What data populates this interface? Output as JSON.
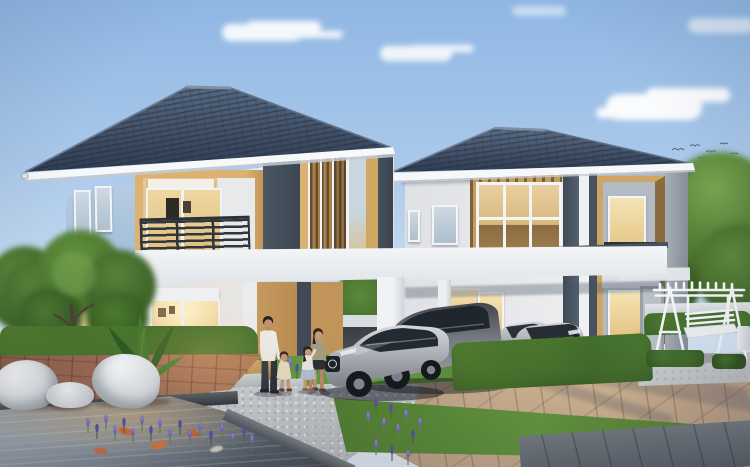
{
  "labels": {
    "scene": "3D rendering of two modern two-storey houses at dusk with garden, carport and koi pond",
    "sky": "Clear evening sky",
    "cloud": "Cloud",
    "birds": "Flock of birds",
    "tree": "Garden tree",
    "gap_tree": "Tree seen through carport",
    "hedge": "Trimmed hedge",
    "house_left": "Left two-storey house",
    "house_right": "Right two-storey house",
    "roof": "Dark slate hip roof",
    "balcony": "Recessed balcony with dark railing",
    "glass_door": "Warm-lit sliding glass door",
    "window": "Window",
    "slat_panel": "Wood slat accent panel",
    "carport": "Carport with white beam and columns",
    "car_sedan": "Silver sedan",
    "car_suv": "Grey SUV",
    "car_pair": "Two silver cars",
    "driveway": "Tan paved driveway",
    "gravel": "Gravel path",
    "lawn": "Lawn strip",
    "walkway": "Grey walkway",
    "patio": "Terracotta patio",
    "terrace": "Wood terrace strip",
    "stones": "Stepping stones",
    "pond": "Koi pond",
    "koi": "Koi fish",
    "lavender": "Purple lavender flowers",
    "plant": "Tropical foliage plant",
    "lounge_chairs": "White sculptural lounge chairs and table",
    "family": "Family of four on the footpath",
    "swing": "White garden swing bench",
    "fence": "White garden wall"
  },
  "palette": {
    "sky_top": "#8fb7e3",
    "sky_horizon": "#e3eef8",
    "roof_dark": "#2f3c52",
    "roof_light": "#566880",
    "fascia": "#f6f8fa",
    "wall_blue_upper": "#b3cae1",
    "wall_blue_lower": "#6795c2",
    "wall_white": "#e9ebed",
    "wall_grey": "#d9dce0",
    "accent_tan": "#d6ac6c",
    "accent_ochre": "#c1945a",
    "accent_slate": "#45515e",
    "wood_slat": "#8a683f",
    "glass_warm": "#e7cb92",
    "glass_cool": "#c3d2df",
    "railing": "#2e353c",
    "band_white": "#f2f4f6",
    "grass": "#5d8c3a",
    "hedge": "#33571f",
    "tree_green": "#4a7630",
    "water": "#5d6873",
    "koi_orange": "#dd6a30",
    "lavender": "#7468c4",
    "paver_tan": "#c3a88b",
    "gravel": "#c6c9cb",
    "patio_brown": "#9a6a50",
    "white_furniture": "#f2f4f6",
    "car_silver": "#b8bbc0",
    "car_grey": "#6a6e73",
    "skin": "#c09070",
    "shirt_white": "#eceae6",
    "top_olive": "#a69d80",
    "skirt_blue": "#b3bfce"
  }
}
